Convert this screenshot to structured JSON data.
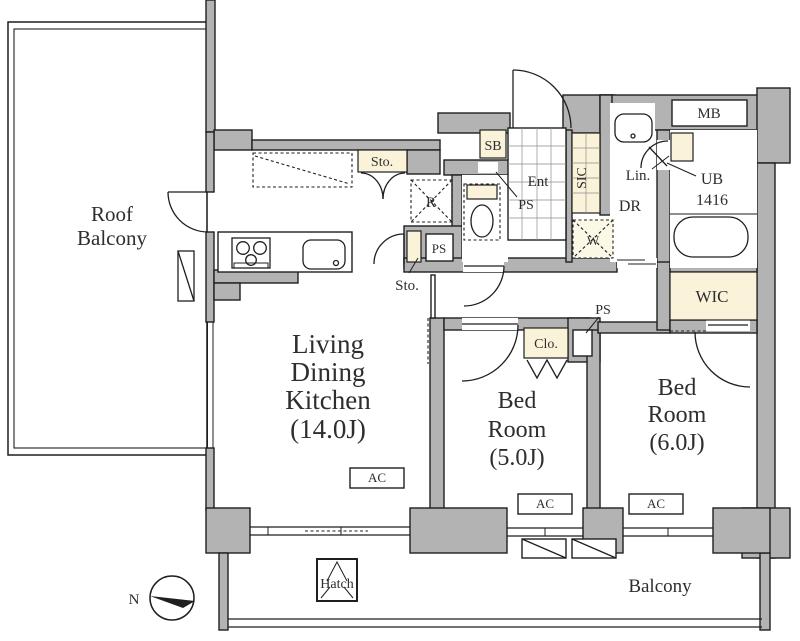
{
  "rooms": {
    "roof_balcony": {
      "line1": "Roof",
      "line2": "Balcony"
    },
    "ldk": {
      "line1": "Living",
      "line2": "Dining",
      "line3": "Kitchen",
      "size": "(14.0J)"
    },
    "bedroom_5": {
      "line1": "Bed",
      "line2": "Room",
      "size": "(5.0J)"
    },
    "bedroom_6": {
      "line1": "Bed",
      "line2": "Room",
      "size": "(6.0J)"
    },
    "balcony": {
      "label": "Balcony"
    }
  },
  "labels": {
    "storage_upper": "Sto.",
    "storage_lower": "Sto.",
    "shoe_box": "SB",
    "entrance": "Ent",
    "pipe_space_entrance": "PS",
    "shoe_in_closet": "SIC",
    "linen": "Lin.",
    "dressing_room": "DR",
    "meter_box": "MB",
    "unit_bath": "UB",
    "unit_bath_size": "1416",
    "walk_in_closet": "WIC",
    "washer": "W",
    "refrigerator": "R",
    "pipe_space_kitchen": "PS",
    "pipe_space_hall": "PS",
    "closet": "Clo.",
    "hatch": "Hatch",
    "north": "N",
    "air_conditioner": "AC"
  },
  "colors": {
    "wall": "#b3b3b3",
    "accent_cream": "#faf3d9",
    "line": "#1f1f1f",
    "text": "#2e2e2e"
  }
}
